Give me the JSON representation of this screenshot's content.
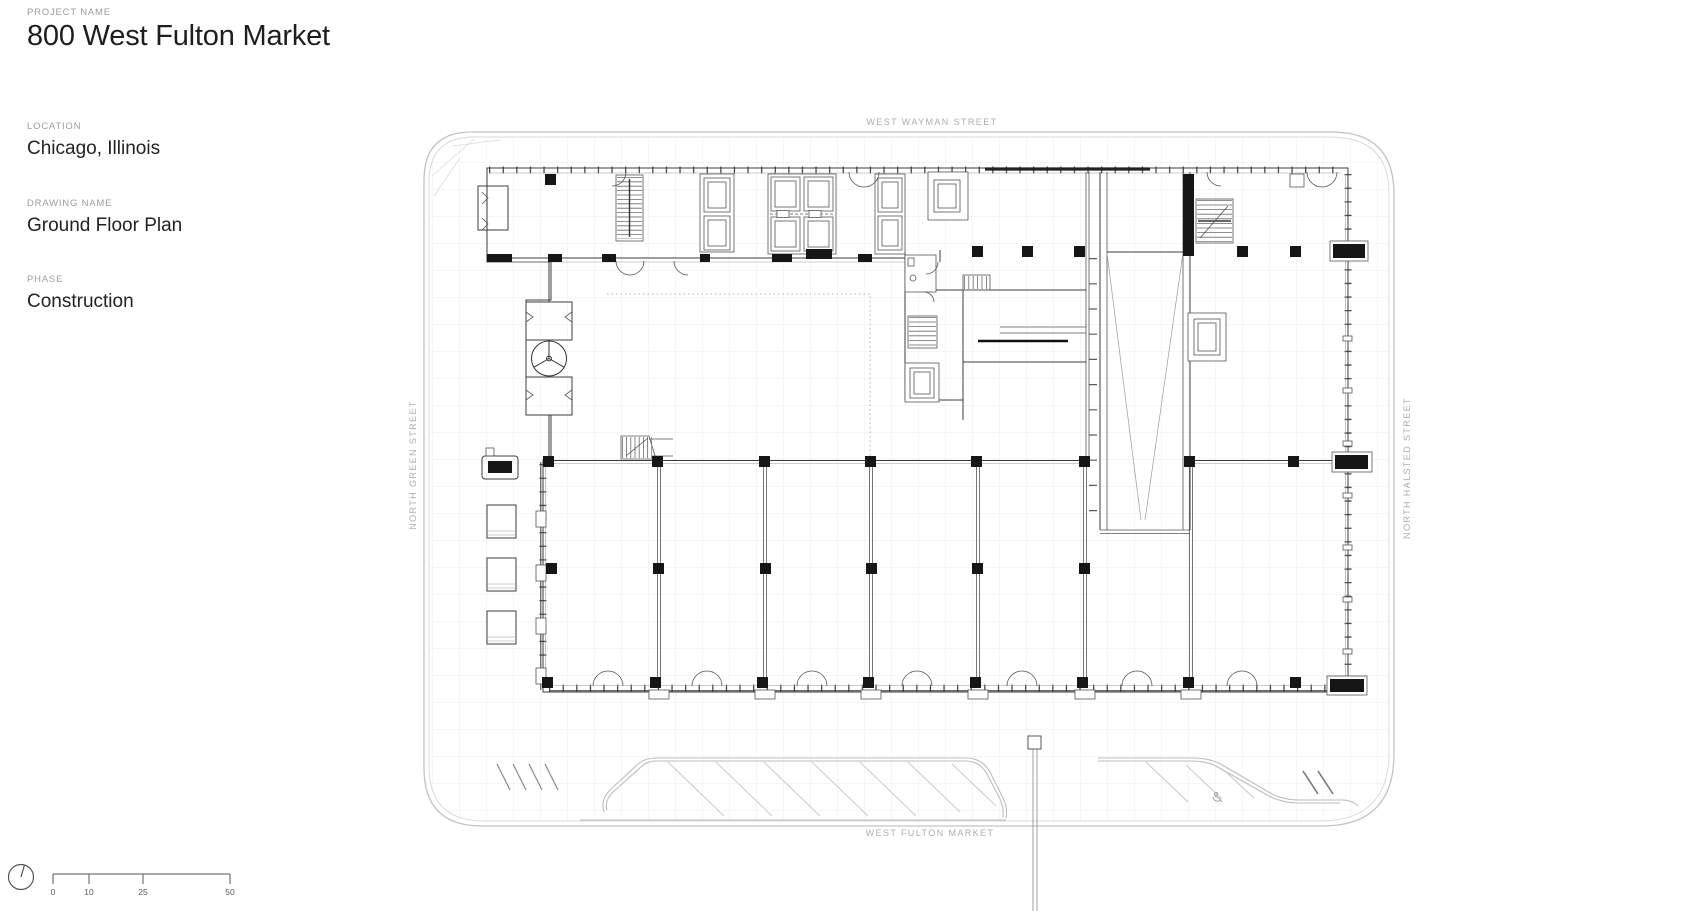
{
  "project": {
    "label": "PROJECT NAME",
    "name": "800 West Fulton Market"
  },
  "location": {
    "label": "LOCATION",
    "value": "Chicago, Illinois"
  },
  "drawing": {
    "label": "DRAWING NAME",
    "value": "Ground Floor Plan"
  },
  "phase": {
    "label": "PHASE",
    "value": "Construction"
  },
  "streets": {
    "north": "WEST WAYMAN STREET",
    "south": "WEST FULTON MARKET",
    "west": "NORTH GREEN STREET",
    "east": "NORTH HALSTED STREET"
  },
  "scale_bar": {
    "ticks": [
      "0",
      "10",
      "25",
      "50"
    ]
  },
  "colors": {
    "background": "#ffffff",
    "ink": "#1f1f1f",
    "muted_label": "#9c9c9c",
    "street_label": "#adadad",
    "plan_line": "#3e3e3e",
    "site_line": "#c3c3c3",
    "column_fill": "#161616"
  }
}
